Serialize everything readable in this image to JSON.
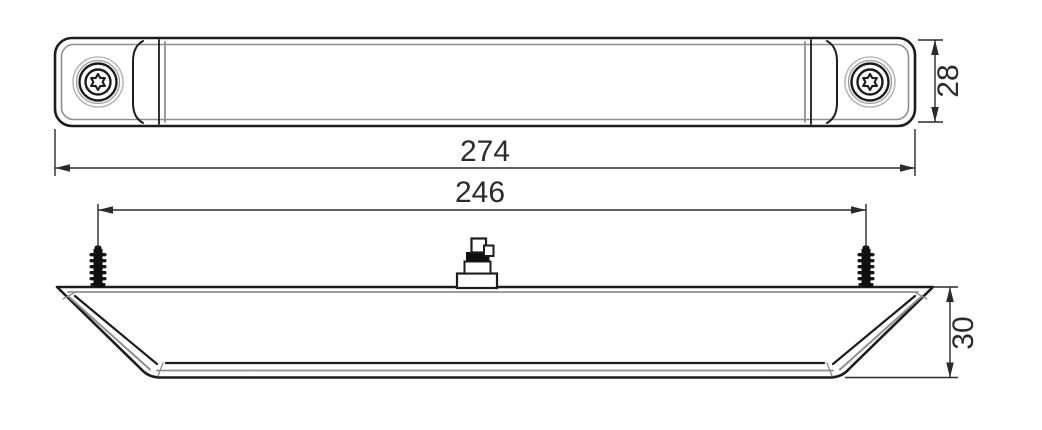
{
  "drawing": {
    "dimensions": {
      "overall_length": "274",
      "fixing_centres": "246",
      "height": "28",
      "depth": "30"
    },
    "colors": {
      "outline": "#1c1c1c",
      "inner_contour": "#8f8f8f",
      "dimension": "#2a2a2a",
      "background": "#ffffff"
    }
  }
}
